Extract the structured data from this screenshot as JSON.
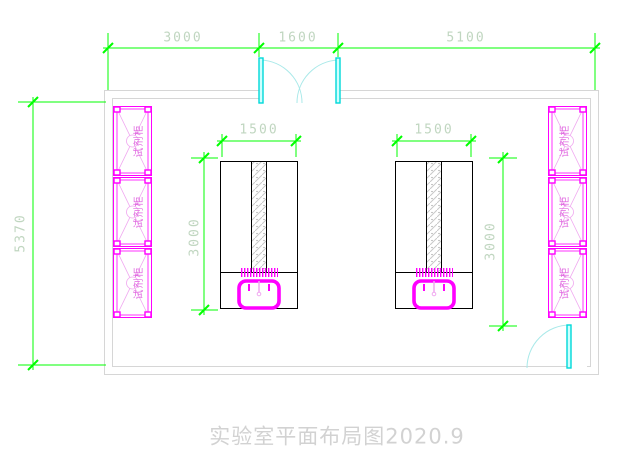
{
  "drawing": {
    "title": "实验室平面布局图2020.9",
    "dims": {
      "top_left": "3000",
      "top_center": "1600",
      "top_right": "5100",
      "wall_height": "5370",
      "bench1_width": "1500",
      "bench1_depth": "3000",
      "bench2_width": "1500",
      "bench2_depth": "3000"
    },
    "cabinets": {
      "left": [
        "试剂柜",
        "试剂柜",
        "试剂柜"
      ],
      "right": [
        "试剂柜",
        "试剂柜",
        "试剂柜"
      ]
    },
    "colors": {
      "dimension_line": "#00ff00",
      "dimension_text": "#c0d6c0",
      "cabinet": "#ff00ff",
      "door": "#00d8d8",
      "wall": "#d6d6d6",
      "bench_outline": "#000000",
      "title_text": "#d2d2d2"
    }
  }
}
